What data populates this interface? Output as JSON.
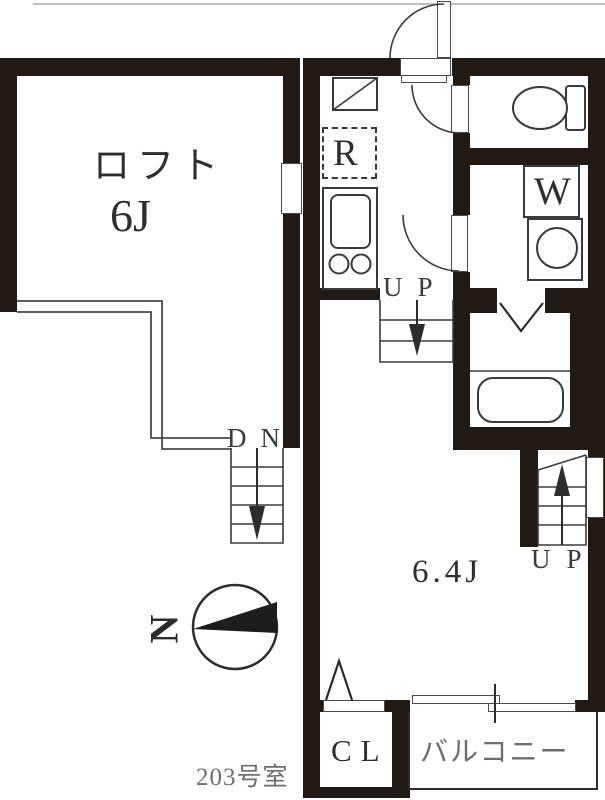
{
  "floorplan": {
    "room_number": "203号室",
    "north_label": "N",
    "loft": {
      "name": "ロフト",
      "size": "6J"
    },
    "main_room": {
      "size": "6.4J"
    },
    "kitchen": {
      "refrigerator": "R"
    },
    "laundry": {
      "washer": "W"
    },
    "closet": {
      "label": "CL"
    },
    "balcony": {
      "label": "バルコニー"
    },
    "stairs": {
      "up_center": "UP",
      "down_loft": "DN",
      "up_right": "UP"
    },
    "colors": {
      "wall": "#211a14",
      "line": "#3a3a3a",
      "text": "#2e2e2e",
      "muted_text": "#6e6e6e",
      "background": "#ffffff"
    }
  }
}
